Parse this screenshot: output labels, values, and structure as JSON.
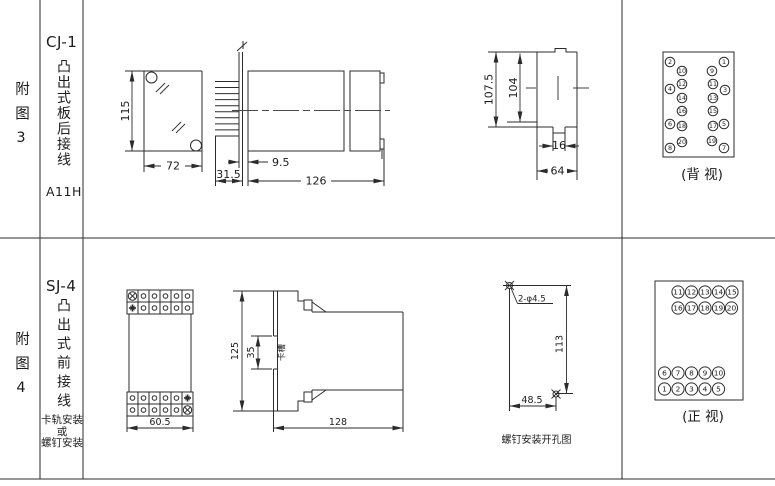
{
  "sheet": {
    "bg": "#ffffff",
    "line_color": "#2b2b2b",
    "text_color": "#1c1c1c"
  },
  "fig3": {
    "row_label": "附图3",
    "model": "CJ-1",
    "mount_type": "凸出式板后接线",
    "code": "A11H",
    "front_view": {
      "dim_height": "115",
      "dim_width": "72"
    },
    "side_view": {
      "dim_panel_gap": "9.5",
      "dim_pin_depth": "31.5",
      "dim_length": "126"
    },
    "cutout_view": {
      "dim_outer_height": "107.5",
      "dim_inner_height": "104",
      "dim_notch_width": "16",
      "dim_width": "64"
    },
    "terminal_view": {
      "caption": "(背 视)",
      "pins": [
        {
          "n": "2",
          "x": 670,
          "y": 62
        },
        {
          "n": "1",
          "x": 724,
          "y": 62
        },
        {
          "n": "10",
          "x": 682,
          "y": 71
        },
        {
          "n": "9",
          "x": 712,
          "y": 71
        },
        {
          "n": "12",
          "x": 682,
          "y": 84
        },
        {
          "n": "11",
          "x": 713,
          "y": 84
        },
        {
          "n": "4",
          "x": 670,
          "y": 89
        },
        {
          "n": "3",
          "x": 725,
          "y": 90
        },
        {
          "n": "14",
          "x": 682,
          "y": 98
        },
        {
          "n": "13",
          "x": 713,
          "y": 98
        },
        {
          "n": "16",
          "x": 682,
          "y": 111
        },
        {
          "n": "15",
          "x": 713,
          "y": 111
        },
        {
          "n": "6",
          "x": 670,
          "y": 124
        },
        {
          "n": "5",
          "x": 724,
          "y": 124
        },
        {
          "n": "18",
          "x": 682,
          "y": 126
        },
        {
          "n": "17",
          "x": 713,
          "y": 126
        },
        {
          "n": "20",
          "x": 682,
          "y": 142
        },
        {
          "n": "19",
          "x": 712,
          "y": 141
        },
        {
          "n": "8",
          "x": 670,
          "y": 148
        },
        {
          "n": "7",
          "x": 724,
          "y": 148
        }
      ]
    }
  },
  "fig4": {
    "row_label": "附图4",
    "model": "SJ-4",
    "mount_type": "凸出式前接线",
    "mount_note": "卡轨安装\n或\n螺钉安装",
    "front_view": {
      "dim_width": "60.5"
    },
    "side_view": {
      "dim_height": "125",
      "dim_slot_height": "35",
      "slot_label": "卡槽",
      "dim_depth": "128"
    },
    "drill_view": {
      "hole_label": "2-φ4.5",
      "dim_vertical": "113",
      "dim_horizontal": "48.5",
      "caption": "螺钉安装开孔图"
    },
    "terminal_view": {
      "caption": "(正 视)",
      "pins": [
        {
          "n": "11",
          "x": 678,
          "y": 292
        },
        {
          "n": "12",
          "x": 691.5,
          "y": 292
        },
        {
          "n": "13",
          "x": 705,
          "y": 292
        },
        {
          "n": "14",
          "x": 718.5,
          "y": 292
        },
        {
          "n": "15",
          "x": 732,
          "y": 292
        },
        {
          "n": "16",
          "x": 678,
          "y": 308
        },
        {
          "n": "17",
          "x": 691.5,
          "y": 308
        },
        {
          "n": "18",
          "x": 705,
          "y": 308
        },
        {
          "n": "19",
          "x": 718.5,
          "y": 308
        },
        {
          "n": "20",
          "x": 731.5,
          "y": 308
        },
        {
          "n": "6",
          "x": 664.5,
          "y": 373
        },
        {
          "n": "7",
          "x": 678,
          "y": 373
        },
        {
          "n": "8",
          "x": 691.5,
          "y": 373
        },
        {
          "n": "9",
          "x": 705,
          "y": 373
        },
        {
          "n": "10",
          "x": 718.5,
          "y": 373
        },
        {
          "n": "1",
          "x": 664.5,
          "y": 389
        },
        {
          "n": "2",
          "x": 678,
          "y": 389
        },
        {
          "n": "3",
          "x": 691.5,
          "y": 389
        },
        {
          "n": "4",
          "x": 705,
          "y": 389
        },
        {
          "n": "5",
          "x": 718.5,
          "y": 389
        }
      ]
    }
  }
}
